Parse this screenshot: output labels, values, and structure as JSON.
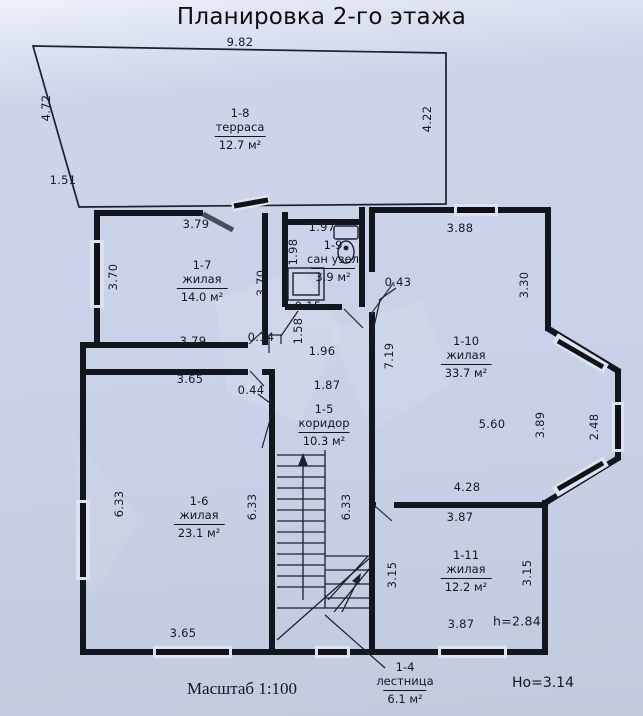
{
  "title": "Планировка 2-го этажа",
  "plan": {
    "rooms": [
      {
        "id": "1-8",
        "type": "терраса",
        "area": "12.7 м²",
        "x": 240,
        "y": 106
      },
      {
        "id": "1-7",
        "type": "жилая",
        "area": "14.0 м²",
        "x": 202,
        "y": 258
      },
      {
        "id": "1-9",
        "type": "сан узел",
        "area": "3.9 м²",
        "x": 333,
        "y": 238
      },
      {
        "id": "1-10",
        "type": "жилая",
        "area": "33.7 м²",
        "x": 466,
        "y": 334
      },
      {
        "id": "1-5",
        "type": "коридор",
        "area": "10.3 м²",
        "x": 324,
        "y": 402
      },
      {
        "id": "1-6",
        "type": "жилая",
        "area": "23.1 м²",
        "x": 199,
        "y": 494
      },
      {
        "id": "1-11",
        "type": "жилая",
        "area": "12.2 м²",
        "x": 466,
        "y": 548
      },
      {
        "id": "1-4",
        "type": "лестница",
        "area": "6.1 м²",
        "x": 405,
        "y": 660
      }
    ],
    "dims": [
      {
        "t": "9.82",
        "x": 240,
        "y": 42
      },
      {
        "t": "4.72",
        "x": 46,
        "y": 108,
        "r": 1
      },
      {
        "t": "4.22",
        "x": 427,
        "y": 119,
        "r": 1
      },
      {
        "t": "1.51",
        "x": 63,
        "y": 180
      },
      {
        "t": "3.79",
        "x": 196,
        "y": 224
      },
      {
        "t": "1.97",
        "x": 322,
        "y": 227
      },
      {
        "t": "3.88",
        "x": 460,
        "y": 228
      },
      {
        "t": "3.70",
        "x": 113,
        "y": 277,
        "r": 1
      },
      {
        "t": "1.98",
        "x": 293,
        "y": 252,
        "r": 1
      },
      {
        "t": "3.70",
        "x": 261,
        "y": 283,
        "r": 1
      },
      {
        "t": "0.43",
        "x": 398,
        "y": 282
      },
      {
        "t": "3.30",
        "x": 524,
        "y": 285,
        "r": 1
      },
      {
        "t": "0.15",
        "x": 308,
        "y": 306
      },
      {
        "t": "1.58",
        "x": 298,
        "y": 331,
        "r": 1
      },
      {
        "t": "3.79",
        "x": 193,
        "y": 341
      },
      {
        "t": "0.14",
        "x": 261,
        "y": 337
      },
      {
        "t": "1.96",
        "x": 322,
        "y": 351
      },
      {
        "t": "7.19",
        "x": 389,
        "y": 356,
        "r": 1
      },
      {
        "t": "3.65",
        "x": 190,
        "y": 379
      },
      {
        "t": "0.44",
        "x": 251,
        "y": 390
      },
      {
        "t": "1.87",
        "x": 327,
        "y": 385
      },
      {
        "t": "5.60",
        "x": 492,
        "y": 424
      },
      {
        "t": "3.89",
        "x": 540,
        "y": 425,
        "r": 1
      },
      {
        "t": "2.48",
        "x": 594,
        "y": 427,
        "r": 1
      },
      {
        "t": "4.28",
        "x": 467,
        "y": 487
      },
      {
        "t": "3.87",
        "x": 460,
        "y": 517
      },
      {
        "t": "6.33",
        "x": 119,
        "y": 504,
        "r": 1
      },
      {
        "t": "6.33",
        "x": 252,
        "y": 507,
        "r": 1
      },
      {
        "t": "6.33",
        "x": 346,
        "y": 507,
        "r": 1
      },
      {
        "t": "3.15",
        "x": 392,
        "y": 575,
        "r": 1
      },
      {
        "t": "3.15",
        "x": 527,
        "y": 573,
        "r": 1
      },
      {
        "t": "3.87",
        "x": 461,
        "y": 624
      },
      {
        "t": "h=2.84",
        "x": 517,
        "y": 621,
        "s": 12.5
      },
      {
        "t": "3.65",
        "x": 183,
        "y": 633
      }
    ],
    "notes": [
      {
        "t": "Масштаб 1:100",
        "x": 242,
        "y": 689,
        "serif": true,
        "s": 17
      },
      {
        "t": "Но=3.14",
        "x": 543,
        "y": 683,
        "s": 14
      }
    ]
  }
}
